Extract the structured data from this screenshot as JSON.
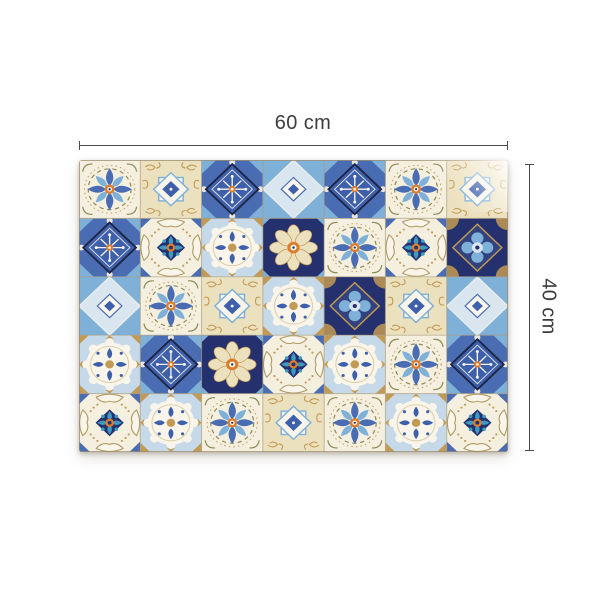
{
  "page": {
    "background": "#ffffff"
  },
  "dimension_annotations": {
    "width": {
      "label": "60 cm"
    },
    "height": {
      "label": "40 cm"
    },
    "line_color": "#4c4c4c",
    "text_color": "#3d3d3d"
  },
  "product": {
    "description": "Rectangular mat with patchwork of Moroccan azulejo-style mosaic tiles in blue, navy, cream, tan and orange; shown 60 cm wide by 40 cm tall with measurement lines",
    "tile_grid": {
      "columns": 7,
      "rows": 5,
      "layout": [
        [
          "flower-white",
          "filigree-beige",
          "snowflake-blue",
          "checker-lightblue",
          "snowflake-blue",
          "flower-white",
          "filigree-beige"
        ],
        [
          "snowflake-blue",
          "scroll-cream",
          "medallion-cream",
          "rosette-navy",
          "flower-white",
          "scroll-cream",
          "quatrefoil-navy"
        ],
        [
          "checker-lightblue",
          "flower-white",
          "filigree-beige",
          "medallion-cream",
          "quatrefoil-navy",
          "filigree-beige",
          "checker-lightblue"
        ],
        [
          "medallion-cream",
          "snowflake-blue",
          "rosette-navy",
          "scroll-cream",
          "medallion-cream",
          "flower-white",
          "snowflake-blue"
        ],
        [
          "scroll-cream",
          "medallion-cream",
          "flower-white",
          "filigree-beige",
          "flower-white",
          "medallion-cream",
          "scroll-cream"
        ]
      ]
    },
    "palette": {
      "royal": "#3e60ab",
      "navy": "#25316e",
      "blue2": "#4a6cb3",
      "sky": "#7fb0d8",
      "pale": "#d9e6f0",
      "cream": "#f4efdf",
      "beige": "#ece1bf",
      "white": "#f9f5ea",
      "tan": "#c39a55",
      "olive": "#8f8a55",
      "teal": "#3f9ac0",
      "orange": "#dd7d2c",
      "grout": "#a89878"
    }
  }
}
